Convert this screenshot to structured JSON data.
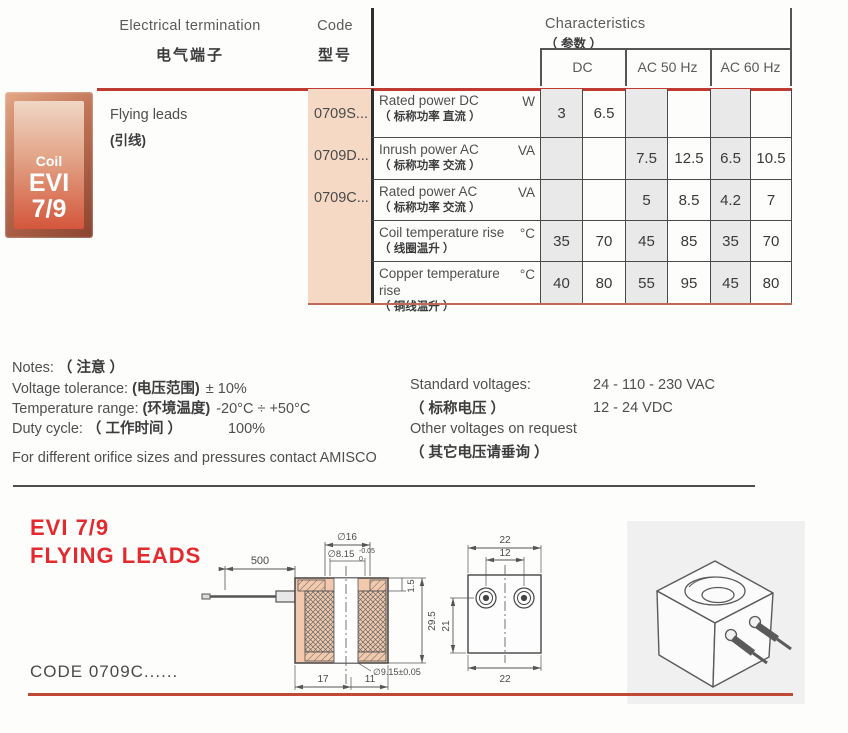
{
  "header": {
    "electrical_termination_en": "Electrical termination",
    "electrical_termination_zh": "电气端子",
    "code_en": "Code",
    "code_zh": "型号",
    "characteristics_en": "Characteristics",
    "characteristics_zh": "（ 参数 ）",
    "columns": [
      "DC",
      "AC 50 Hz",
      "AC 60 Hz"
    ]
  },
  "table": {
    "badge": {
      "line1": "Coil",
      "line2": "EVI",
      "line3": "7/9"
    },
    "termination_en": "Flying leads",
    "termination_zh": "(引线)",
    "codes": [
      "0709S...",
      "0709D...",
      "0709C..."
    ],
    "rows": [
      {
        "label_en": "Rated power DC",
        "label_zh": "（ 标称功率 直流 ）",
        "unit": "W",
        "values": [
          "3",
          "6.5",
          "",
          "",
          "",
          ""
        ]
      },
      {
        "label_en": "Inrush power AC",
        "label_zh": "（ 标称功率 交流 ）",
        "unit": "VA",
        "values": [
          "",
          "",
          "7.5",
          "12.5",
          "6.5",
          "10.5"
        ]
      },
      {
        "label_en": "Rated power AC",
        "label_zh": "（ 标称功率 交流 ）",
        "unit": "VA",
        "values": [
          "",
          "",
          "5",
          "8.5",
          "4.2",
          "7"
        ]
      },
      {
        "label_en": "Coil temperature rise",
        "label_zh": "（ 线圈温升 ）",
        "unit": "°C",
        "values": [
          "35",
          "70",
          "45",
          "85",
          "35",
          "70"
        ]
      },
      {
        "label_en": "Copper temperature rise",
        "label_zh": "（ 铜线温升 ）",
        "unit": "°C",
        "values": [
          "40",
          "80",
          "55",
          "95",
          "45",
          "80"
        ]
      }
    ]
  },
  "notes": {
    "title_en": "Notes:",
    "title_zh": "（ 注意 ）",
    "lines": [
      {
        "en": "Voltage tolerance:",
        "zh": "(电压范围)",
        "value": "± 10%"
      },
      {
        "en": "Temperature range:",
        "zh": "(环境温度)",
        "value": "-20°C ÷ +50°C"
      },
      {
        "en": "Duty cycle:",
        "zh": "（ 工作时间 ）",
        "value": "100%"
      }
    ],
    "footer": "For different orifice sizes and pressures contact AMISCO"
  },
  "voltages": {
    "standard_en": "Standard voltages:",
    "standard_zh": "（ 标称电压 ）",
    "standard_values": [
      "24 - 110 - 230 VAC",
      "12 - 24 VDC"
    ],
    "other_en": "Other voltages on request",
    "other_zh": "（ 其它电压请垂询 ）"
  },
  "drawing": {
    "section_title_line1": "EVI 7/9",
    "section_title_line2": "FLYING LEADS",
    "code_label": "CODE 0709C......",
    "cross_section": {
      "lead_length": "500",
      "dia_top": "∅16",
      "dia_inner": "∅8.15",
      "dia_inner_tol_upper": "-0.05",
      "dia_inner_tol_lower": "0",
      "flange_height": "1.5",
      "body_height": "29.5",
      "dia_bottom": "∅9.15±0.05",
      "width_left": "17",
      "width_right": "11"
    },
    "front_view": {
      "width_top": "22",
      "hole_spacing": "12",
      "height_side": "21",
      "width_bottom": "22"
    }
  },
  "colors": {
    "accent_red": "#bf3a30",
    "title_red": "#e42a2e",
    "code_column_bg": "#f5d9c4",
    "cell_shade": "#e9e9e9",
    "panel_gray": "#f0f0f1"
  }
}
